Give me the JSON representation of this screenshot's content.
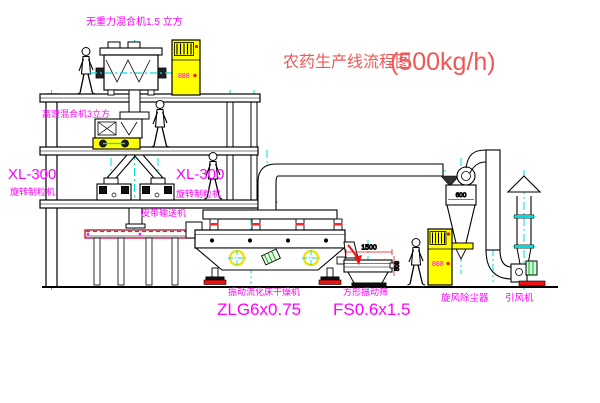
{
  "title": {
    "text": "农药生产线流程图",
    "capacity": "(500kg/h)"
  },
  "machines": {
    "gravity_mixer": {
      "label": "无重力混合机1.5 立方"
    },
    "high_speed_mixer": {
      "label": "高速混合机3立方"
    },
    "granulator_left": {
      "model": "XL-300",
      "name": "旋转制粒机"
    },
    "granulator_right": {
      "model": "XL-300",
      "name": "旋转制粒机"
    },
    "belt_conveyor": {
      "name": "皮带输送机"
    },
    "fluid_bed_dryer": {
      "name": "振动流化床干燥机",
      "model": "ZLG6x0.75"
    },
    "vibrating_screen": {
      "name": "方形振动筛",
      "model": "FS0.6x1.5"
    },
    "cyclone": {
      "name": "旋风除尘器"
    },
    "draft_fan": {
      "name": "引风机"
    }
  },
  "dimensions": {
    "screen_length": "1500",
    "screen_height": "500",
    "cyclone_inlet": "600"
  },
  "cabinets": {
    "display": "888"
  },
  "colors": {
    "line": "#000000",
    "centerline": "#00dede",
    "label_magenta": "#ff00ff",
    "title_red": "#f25555",
    "accent_red": "#ee1111",
    "accent_green": "#00a000",
    "highlight_yellow": "#ffff00"
  }
}
